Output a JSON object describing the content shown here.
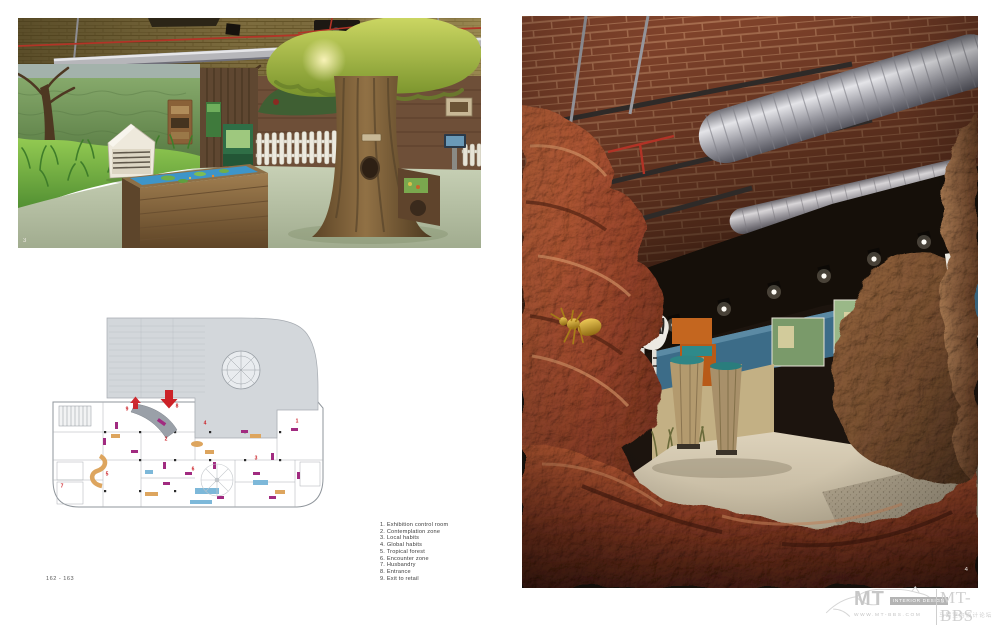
{
  "page": {
    "label": "162 - 163"
  },
  "figures": {
    "left_photo": {
      "number": "3"
    },
    "right_photo": {
      "number": "4"
    }
  },
  "plan": {
    "numbers": [
      "1",
      "2",
      "3",
      "4",
      "5",
      "6",
      "7",
      "8",
      "9"
    ]
  },
  "legend": {
    "items": [
      "1. Exhibition control room",
      "2. Contemplation zone",
      "3. Local habits",
      "4. Global habits",
      "5. Tropical forest",
      "6. Encounter zone",
      "7. Husbandry",
      "8. Entrance",
      "9. Exit to retail"
    ]
  },
  "watermark": {
    "mt": "MT",
    "tagline": "INTERIOR DESIGN",
    "url": "WWW.MT-BBS.COM",
    "brand": "MT-BBS",
    "chinese": "马蹄室内设计论坛"
  },
  "colors": {
    "accent-red": "#cc2127",
    "plan-magenta": "#a12b80",
    "plan-gray": "#d3d7db",
    "watermark-gray": "#c9c9c9"
  }
}
